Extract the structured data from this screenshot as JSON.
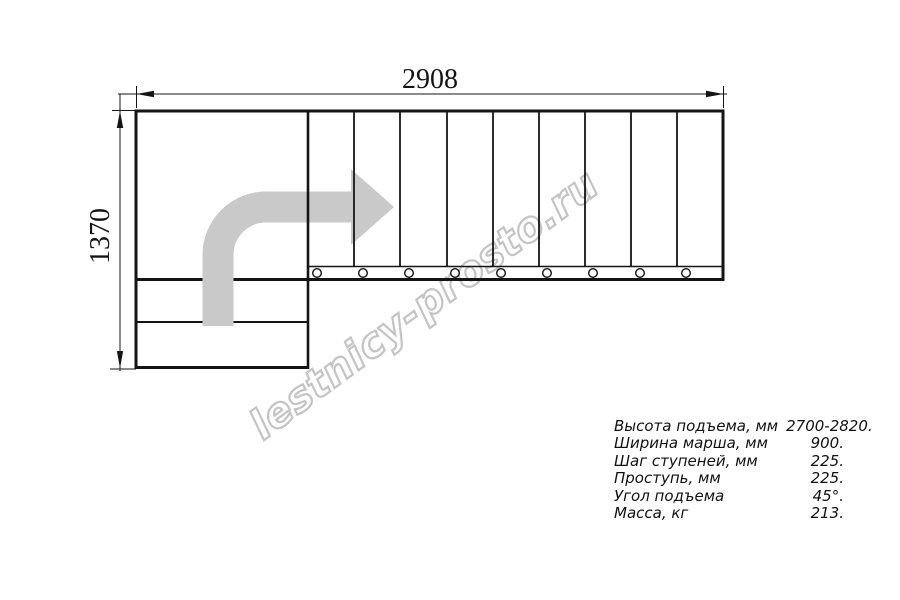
{
  "drawing_title": "staircase-plan-top-view",
  "dimensions": {
    "width_mm": "2908",
    "height_mm": "1370"
  },
  "watermark": {
    "text": "lestnicy-prosto.ru"
  },
  "specs": {
    "rows": [
      {
        "label": "Высота подъема, мм",
        "value": "2700-2820."
      },
      {
        "label": "Ширина марша, мм",
        "value": "900."
      },
      {
        "label": "Шаг ступеней, мм",
        "value": "225."
      },
      {
        "label": "Проступь, мм",
        "value": "225."
      },
      {
        "label": "Угол подъема",
        "value": "45°."
      },
      {
        "label": "Масса, кг",
        "value": "213."
      }
    ]
  },
  "drawing": {
    "tread_count": 9,
    "tread_boundaries_x": [
      354,
      400,
      447,
      493,
      539,
      585,
      631,
      677
    ],
    "bolt_circles_x": [
      317,
      363,
      409,
      455,
      501,
      547,
      593,
      640,
      686
    ],
    "direction_arrow": "up-then-right",
    "colors": {
      "line": "#141414",
      "arrow": "#c9c9c9",
      "watermark_outline": "#c4c4c4"
    }
  }
}
